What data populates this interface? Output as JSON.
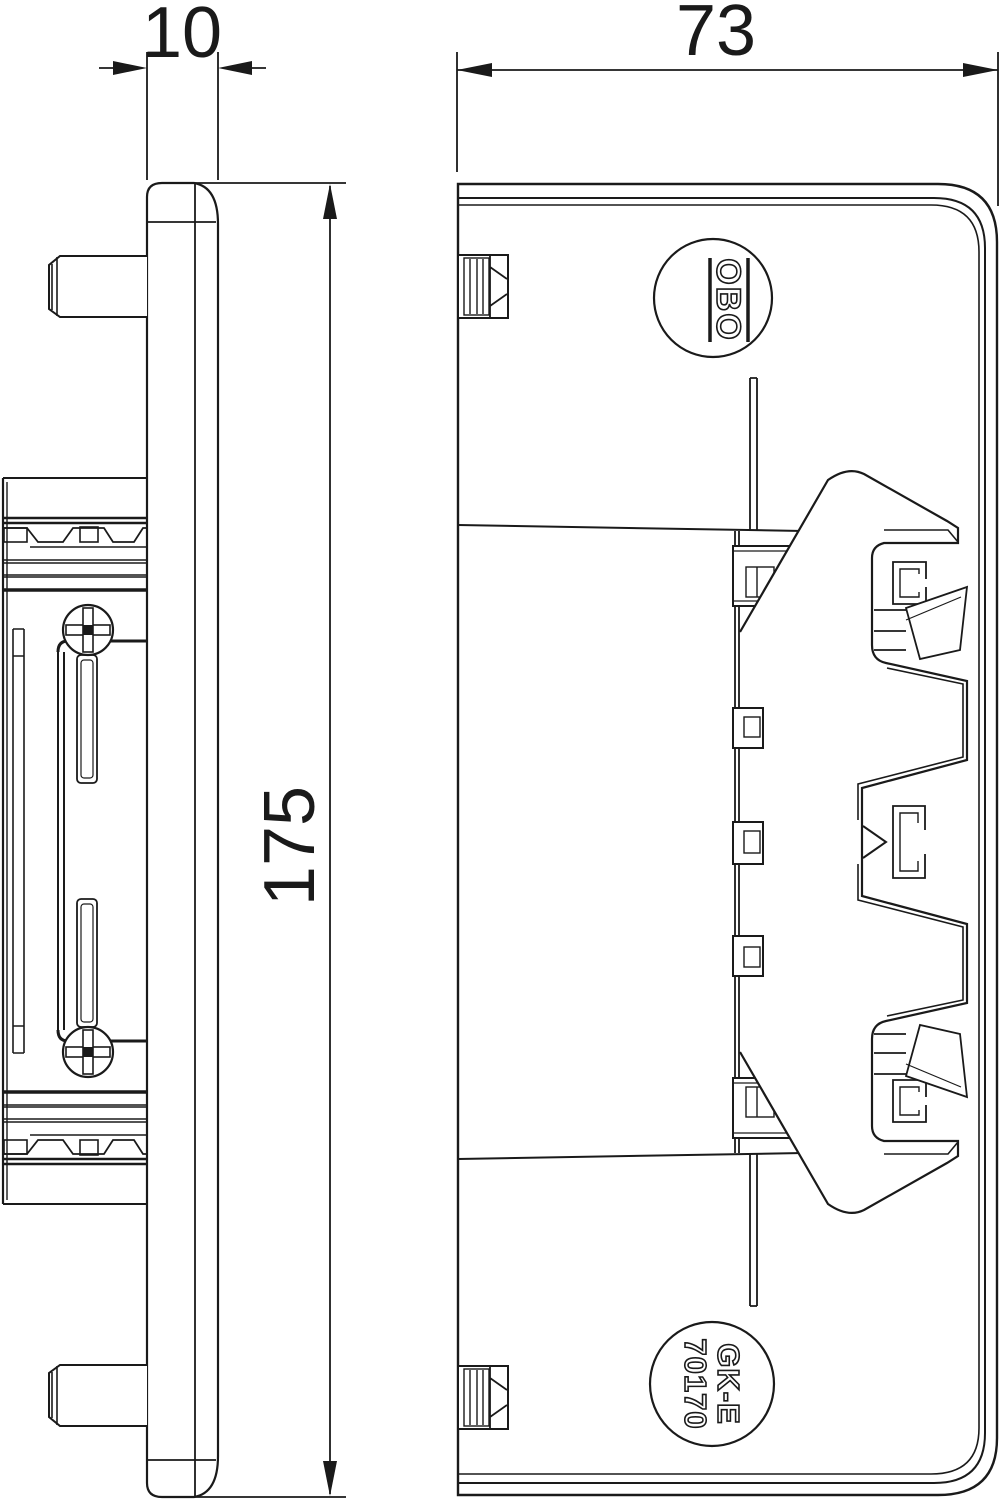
{
  "drawing": {
    "type": "technical-drawing",
    "views": {
      "side_view": "profile view with mounting tabs, rail block, screws",
      "front_view": "section view with latch mechanism and part labels"
    },
    "dimensions": {
      "plate_thickness": "10",
      "width": "73",
      "height": "175"
    },
    "labels": {
      "brand": "OBO",
      "part_code_line1": "GK-E",
      "part_code_line2": "70170"
    },
    "colors": {
      "line": "#1a1a1a",
      "background": "#ffffff"
    }
  }
}
